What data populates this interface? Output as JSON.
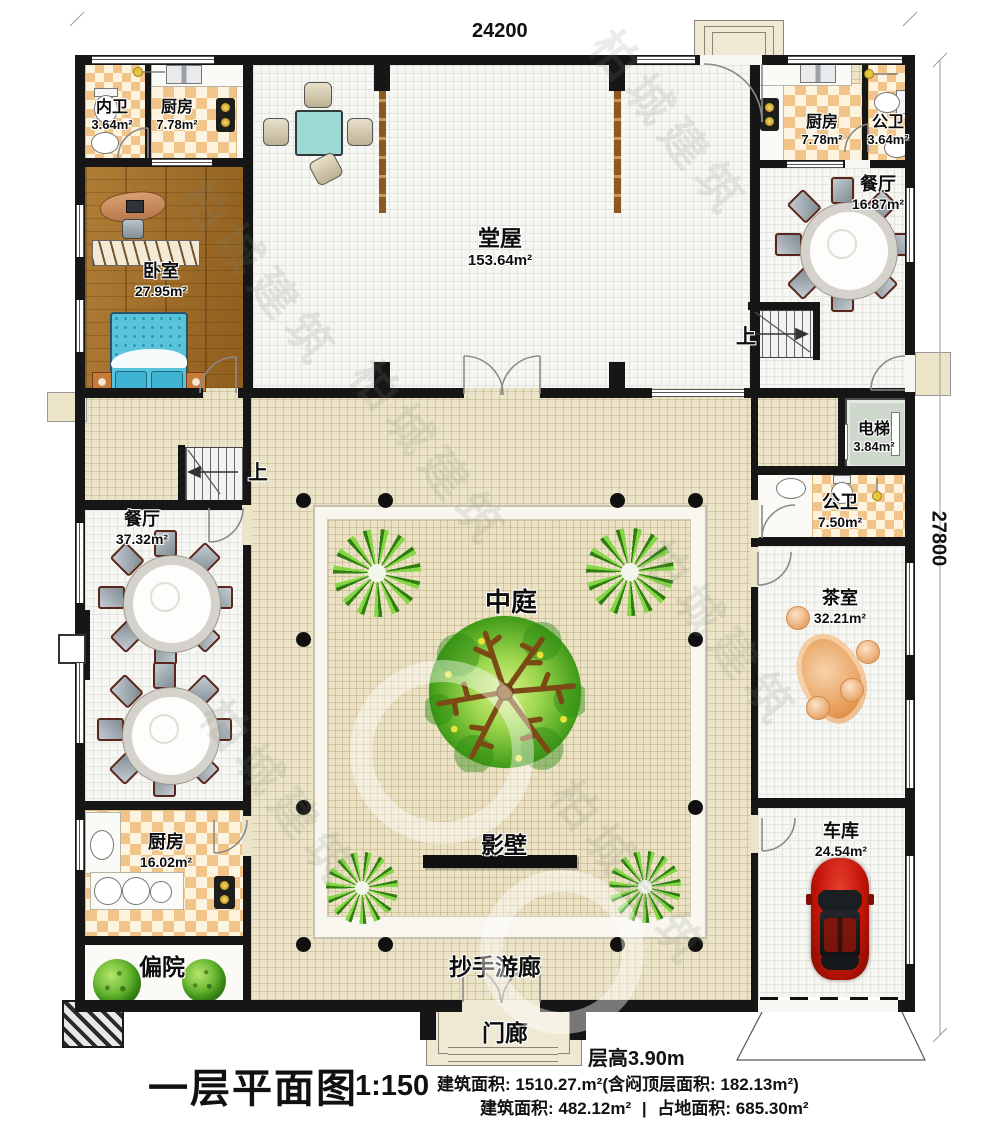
{
  "meta": {
    "plan_title": "一层平面图",
    "scale": "1:150"
  },
  "dimensions": {
    "width_top": "24200",
    "height_right": "27800"
  },
  "labels": {
    "up": "上",
    "courtyard": "中庭",
    "screen_wall": "影壁",
    "veranda": "抄手游廊",
    "porch": "门廊",
    "side_yard": "偏院",
    "floor_height": "层高3.90m"
  },
  "rooms": {
    "inner_bath": {
      "name": "内卫",
      "area": "3.64m²"
    },
    "kitchen_top_left": {
      "name": "厨房",
      "area": "7.78m²"
    },
    "main_hall": {
      "name": "堂屋",
      "area": "153.64m²"
    },
    "kitchen_top_right": {
      "name": "厨房",
      "area": "7.78m²"
    },
    "public_bath_top": {
      "name": "公卫",
      "area": "3.64m²"
    },
    "dining_right": {
      "name": "餐厅",
      "area": "16.87m²"
    },
    "bedroom": {
      "name": "卧室",
      "area": "27.95m²"
    },
    "elevator": {
      "name": "电梯",
      "area": "3.84m²"
    },
    "public_bath_right": {
      "name": "公卫",
      "area": "7.50m²"
    },
    "dining_left": {
      "name": "餐厅",
      "area": "37.32m²"
    },
    "tea_room": {
      "name": "茶室",
      "area": "32.21m²"
    },
    "kitchen_bottom_left": {
      "name": "厨房",
      "area": "16.02m²"
    },
    "garage": {
      "name": "车库",
      "area": "24.54m²"
    }
  },
  "footer": {
    "area_line1": "建筑面积: 1510.27.m²(含闷顶层面积: 182.13m²)",
    "area_line2a": "建筑面积: 482.12m²",
    "divider": "|",
    "area_line2b": "占地面积: 685.30m²"
  },
  "watermark": {
    "text": "柏城建筑"
  }
}
